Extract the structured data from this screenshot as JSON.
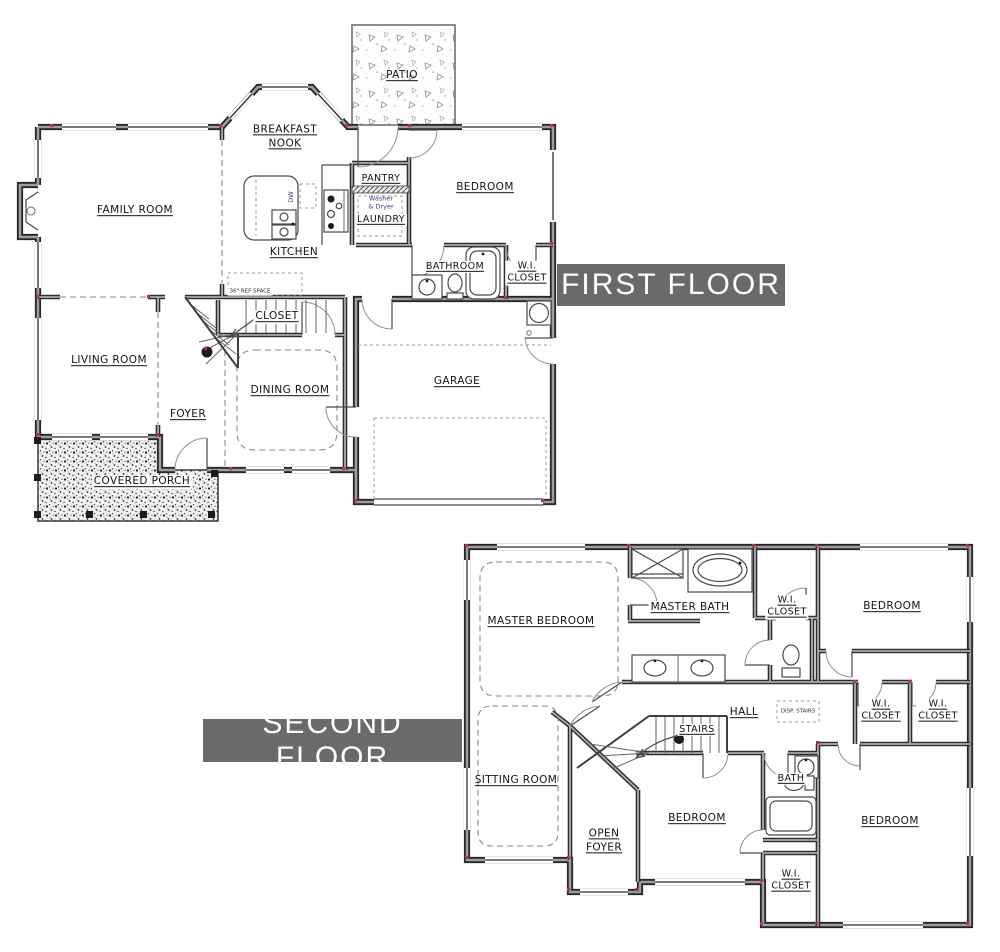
{
  "banners": {
    "first_floor": "FIRST FLOOR",
    "second_floor": "SECOND FLOOR"
  },
  "colors": {
    "banner_bg": "#6a6a6a",
    "banner_text": "#ffffff",
    "wall_edge": "#262626",
    "wall_core": "#9e9e9e",
    "corner_accent_red": "#b33a32",
    "appliance_label_blue": "#3a3a8f",
    "paper": "#ffffff"
  },
  "first_floor": {
    "labels": {
      "breakfast_nook": "BREAKFAST\nNOOK",
      "patio": "PATIO",
      "family_room": "FAMILY ROOM",
      "kitchen": "KITCHEN",
      "pantry": "PANTRY",
      "laundry": "LAUNDRY",
      "washer_dryer": "Washer\n& Dryer",
      "dw": "DW",
      "ref_space": "36\" REF SPACE",
      "bedroom": "BEDROOM",
      "bathroom": "BATHROOM",
      "wi_closet": "W.I.\nCLOSET",
      "closet": "CLOSET",
      "living_room": "LIVING ROOM",
      "foyer": "FOYER",
      "dining_room": "DINING ROOM",
      "garage": "GARAGE",
      "covered_porch": "COVERED PORCH"
    }
  },
  "second_floor": {
    "labels": {
      "master_bedroom": "MASTER BEDROOM",
      "master_bath": "MASTER BATH",
      "wi_closet_master": "W.I.\nCLOSET",
      "bedroom_top_right": "BEDROOM",
      "hall": "HALL",
      "disp_stairs": "DISP. STAIRS",
      "stairs": "STAIRS",
      "wi_closet_mid_left": "W.I.\nCLOSET",
      "wi_closet_mid_right": "W.I.\nCLOSET",
      "sitting_room": "SITTING ROOM",
      "open_foyer": "OPEN\nFOYER",
      "bath": "BATH",
      "bedroom_bottom_middle": "BEDROOM",
      "bedroom_bottom_right": "BEDROOM",
      "wi_closet_bottom": "W.I.\nCLOSET"
    }
  }
}
